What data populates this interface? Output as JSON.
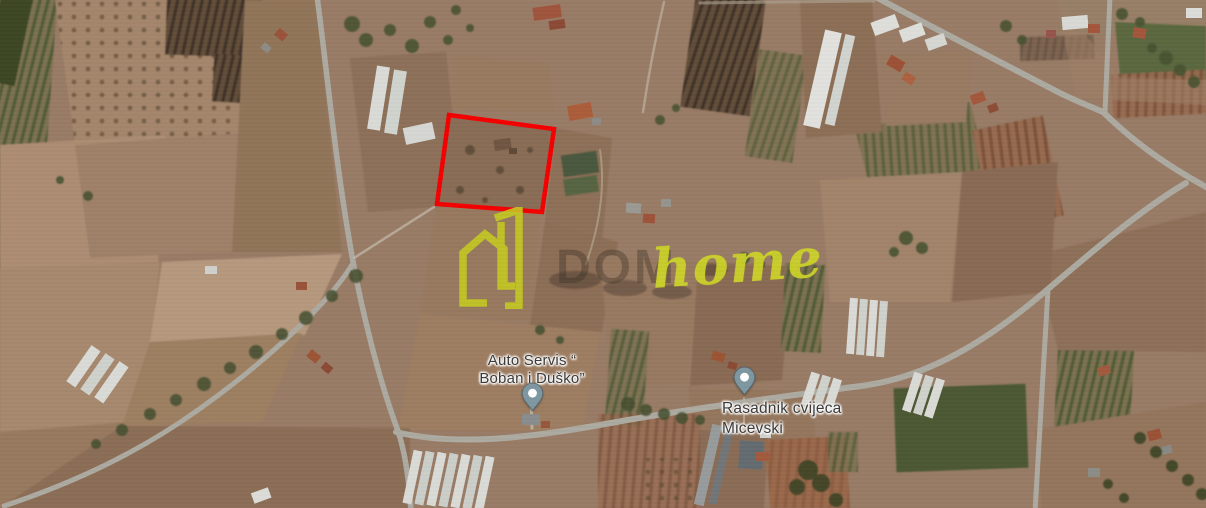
{
  "map": {
    "view_type": "satellite",
    "parcel": {
      "outline_points": "449,115 554,129 542,212 437,204",
      "outline_color": "#f40000"
    },
    "watermark": {
      "ghost_text": "DOM",
      "brand_text": "home",
      "color": "#ccd22a"
    },
    "pois": [
      {
        "id": "auto-servis",
        "line1": "Auto Servis “",
        "line2": "Boban i Duško”"
      },
      {
        "id": "rasadnik-micevski",
        "line1": "Rasadnik cvijeca",
        "line2": "Micevski"
      }
    ],
    "pin_fill": "#7e97a1"
  }
}
